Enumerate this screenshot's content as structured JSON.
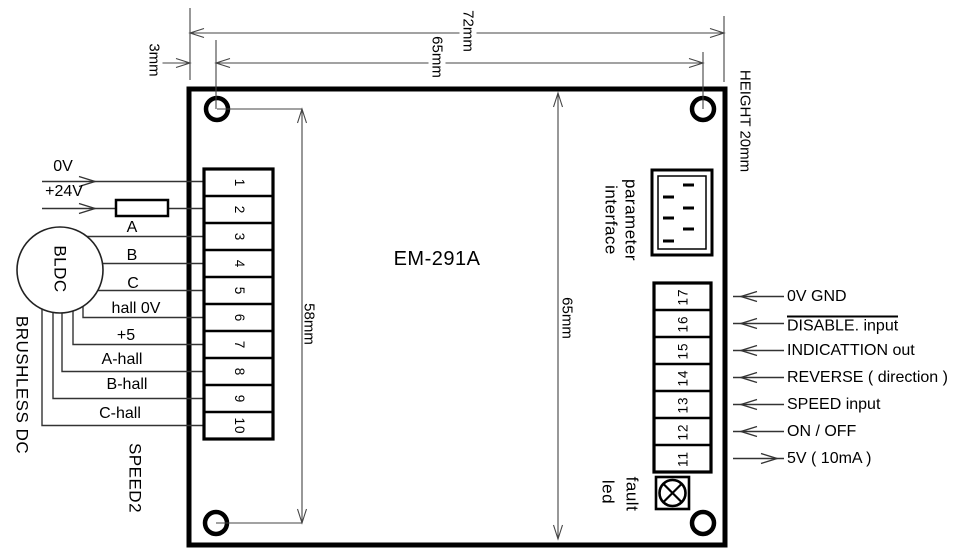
{
  "colors": {
    "ink": "#000000",
    "dim_line": "#444444",
    "background": "#ffffff"
  },
  "board": {
    "model": "EM-291A"
  },
  "dims": {
    "offset_3mm": "3mm",
    "top_width_65mm": "65mm",
    "top_width_72mm": "72mm",
    "height_20mm": "HEIGHT 20mm",
    "left_58mm": "58mm",
    "mid_65mm": "65mm"
  },
  "left": {
    "supply": [
      "0V",
      "+24V"
    ],
    "motor_label": "BLDC",
    "motor_caption": "BRUSHLESS DC",
    "phases": [
      "A",
      "B",
      "C"
    ],
    "halls": [
      "hall 0V",
      "+5",
      "A-hall",
      "B-hall",
      "C-hall"
    ],
    "speed": "SPEED2",
    "terminals": [
      "1",
      "2",
      "3",
      "4",
      "5",
      "6",
      "7",
      "8",
      "9",
      "10"
    ]
  },
  "right": {
    "connector": [
      "parameter",
      "interface"
    ],
    "terminals": [
      "17",
      "16",
      "15",
      "14",
      "13",
      "12",
      "11"
    ],
    "signals": [
      {
        "label": "0V GND",
        "overline": false,
        "direction": "in"
      },
      {
        "label": "DISABLE. input",
        "overline": true,
        "direction": "in"
      },
      {
        "label": "INDICATTION out",
        "overline": false,
        "direction": "in"
      },
      {
        "label": "REVERSE ( direction )",
        "overline": false,
        "direction": "in"
      },
      {
        "label": "SPEED input",
        "overline": false,
        "direction": "in"
      },
      {
        "label": "ON / OFF",
        "overline": false,
        "direction": "in"
      },
      {
        "label": "5V ( 10mA )",
        "overline": false,
        "direction": "out"
      }
    ],
    "led": [
      "fault",
      "led"
    ]
  }
}
